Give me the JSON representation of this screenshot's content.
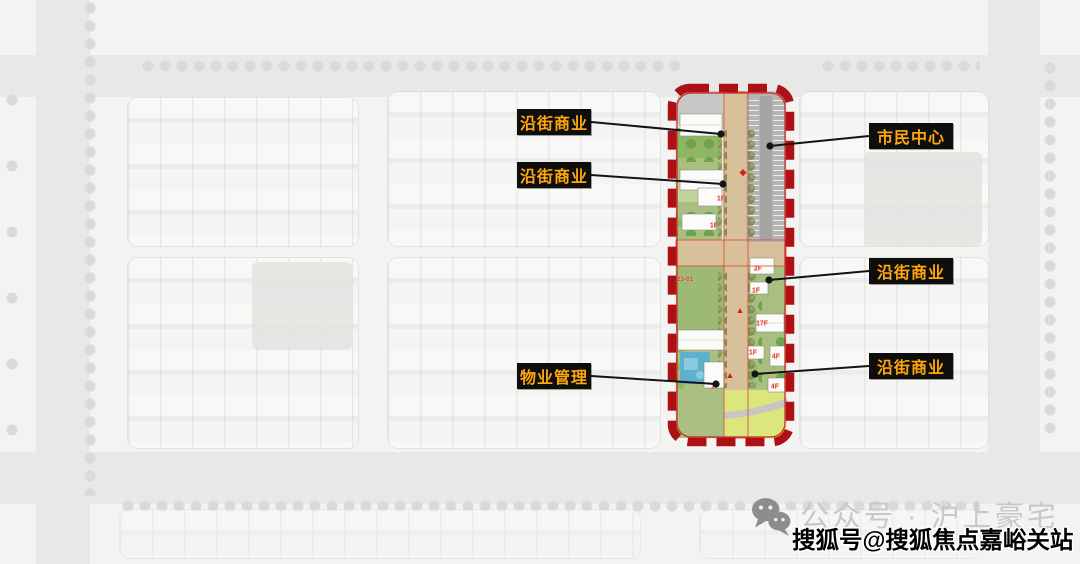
{
  "callouts": [
    {
      "label": "沿街商业",
      "side": "left",
      "box": {
        "x": 517,
        "y": 109,
        "w": 74,
        "h": 26
      },
      "dot": {
        "x": 721,
        "y": 134
      }
    },
    {
      "label": "沿街商业",
      "side": "left",
      "box": {
        "x": 517,
        "y": 162,
        "w": 74,
        "h": 26
      },
      "dot": {
        "x": 723,
        "y": 184
      }
    },
    {
      "label": "市民中心",
      "side": "right",
      "box": {
        "x": 869,
        "y": 123,
        "w": 84,
        "h": 26
      },
      "dot": {
        "x": 770,
        "y": 146
      }
    },
    {
      "label": "沿街商业",
      "side": "right",
      "box": {
        "x": 869,
        "y": 258,
        "w": 84,
        "h": 26
      },
      "dot": {
        "x": 769,
        "y": 280
      }
    },
    {
      "label": "沿街商业",
      "side": "right",
      "box": {
        "x": 869,
        "y": 353,
        "w": 84,
        "h": 26
      },
      "dot": {
        "x": 755,
        "y": 374
      }
    },
    {
      "label": "物业管理",
      "side": "left",
      "box": {
        "x": 517,
        "y": 363,
        "w": 74,
        "h": 26
      },
      "dot": {
        "x": 716,
        "y": 384
      }
    }
  ],
  "plan": {
    "floor_tags": [
      {
        "text": "1F",
        "x": 53,
        "y": 115
      },
      {
        "text": "1F",
        "x": 46,
        "y": 142
      },
      {
        "text": "2F",
        "x": 90,
        "y": 185
      },
      {
        "text": "1F",
        "x": 88,
        "y": 207
      },
      {
        "text": "17F",
        "x": 94,
        "y": 240
      },
      {
        "text": "1F",
        "x": 85,
        "y": 269
      },
      {
        "text": "4F",
        "x": 108,
        "y": 273
      },
      {
        "text": "4F",
        "x": 107,
        "y": 303
      },
      {
        "text": "1F",
        "x": 47,
        "y": 303
      }
    ],
    "parcel_tag": {
      "text": "23-01",
      "x": 17,
      "y": 196
    }
  },
  "watermarks": {
    "wechat_label": "公众号 · 沪上豪宅",
    "sohu_label": "搜狐号@搜狐焦点嘉峪关站"
  },
  "colors": {
    "callout_bg": "#0e0e0d",
    "callout_text": "#ffa70c",
    "boundary_red": "#ad1015",
    "curb_red": "#d94a30",
    "road_tan": "#d8c09b",
    "parking_gray": "#b4b4b2",
    "lawn_green": "#dbe77c",
    "pool_blue": "#5fb0cd",
    "floor_tag_red": "#e03424",
    "leader_black": "#141414",
    "watermark_gray": "#c8c8c6",
    "watermark_black": "#000000"
  }
}
